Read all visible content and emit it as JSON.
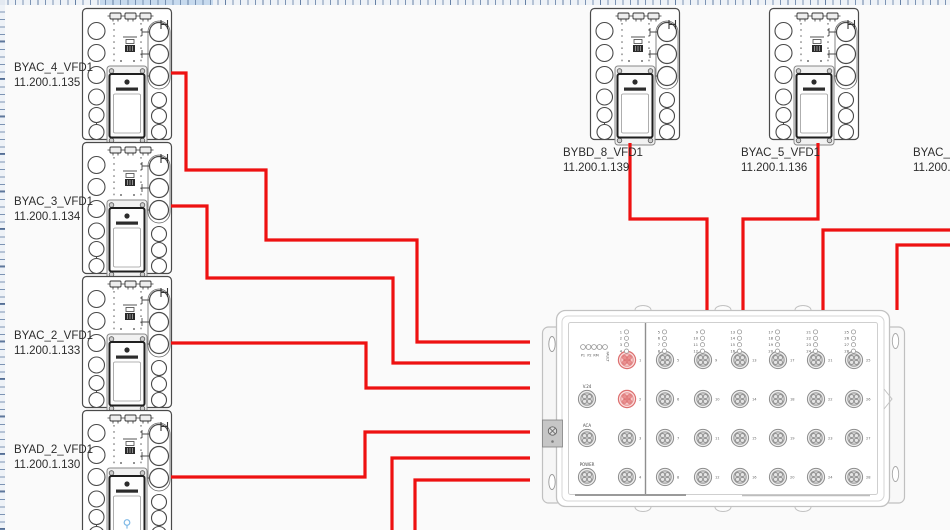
{
  "colors": {
    "connection_red": "#ee1111",
    "canvas_bg": "#fafafa",
    "highlight_port": "#e88787"
  },
  "devices": [
    {
      "id": "byac4",
      "name": "BYAC_4_VFD1",
      "ip": "11.200.1.135"
    },
    {
      "id": "byac3",
      "name": "BYAC_3_VFD1",
      "ip": "11.200.1.134"
    },
    {
      "id": "byac2",
      "name": "BYAC_2_VFD1",
      "ip": "11.200.1.133"
    },
    {
      "id": "byad2",
      "name": "BYAD_2_VFD1",
      "ip": "11.200.1.130"
    },
    {
      "id": "bybd8",
      "name": "BYBD_8_VFD1",
      "ip": "11.200.1.139"
    },
    {
      "id": "byac5",
      "name": "BYAC_5_VFD1",
      "ip": "11.200.1.136"
    },
    {
      "id": "byac6",
      "name": "BYAC_6_",
      "ip": "11.200.1"
    }
  ],
  "switch": {
    "status_leds": [
      "P1",
      "P2",
      "RM",
      "FAULT"
    ],
    "side_ports": [
      "V.24",
      "ACA",
      "POWER"
    ],
    "port_columns": [
      [
        1,
        2,
        3,
        4
      ],
      [
        5,
        6,
        7,
        8
      ],
      [
        9,
        10,
        11,
        12
      ],
      [
        13,
        14,
        15,
        16
      ],
      [
        17,
        18,
        19,
        20
      ],
      [
        21,
        22,
        23,
        24
      ],
      [
        25,
        26,
        27,
        28
      ]
    ],
    "highlighted_ports": [
      1,
      2
    ]
  },
  "connections": [
    {
      "from": "BYAC_4_VFD1",
      "to": "switch",
      "points": [
        [
          171,
          73
        ],
        [
          186,
          73
        ],
        [
          186,
          170
        ],
        [
          266,
          170
        ],
        [
          266,
          240
        ],
        [
          417,
          240
        ],
        [
          417,
          342
        ],
        [
          530,
          342
        ]
      ]
    },
    {
      "from": "BYAC_3_VFD1",
      "to": "switch",
      "points": [
        [
          171,
          206
        ],
        [
          207,
          206
        ],
        [
          207,
          278
        ],
        [
          393,
          278
        ],
        [
          393,
          363
        ],
        [
          530,
          363
        ]
      ]
    },
    {
      "from": "BYAC_2_VFD1",
      "to": "switch",
      "points": [
        [
          171,
          343
        ],
        [
          366,
          343
        ],
        [
          366,
          388
        ],
        [
          530,
          388
        ]
      ]
    },
    {
      "from": "BYAD_2_VFD1",
      "to": "switch",
      "points": [
        [
          171,
          477
        ],
        [
          365,
          477
        ],
        [
          365,
          432
        ],
        [
          530,
          432
        ]
      ]
    },
    {
      "from": "offscreen-bottom-1",
      "to": "switch",
      "points": [
        [
          392,
          531
        ],
        [
          392,
          458
        ],
        [
          530,
          458
        ]
      ]
    },
    {
      "from": "offscreen-bottom-2",
      "to": "switch",
      "points": [
        [
          415,
          531
        ],
        [
          415,
          480
        ],
        [
          530,
          480
        ]
      ]
    },
    {
      "from": "BYBD_8_VFD1",
      "to": "switch",
      "points": [
        [
          630,
          143
        ],
        [
          630,
          219
        ],
        [
          707,
          219
        ],
        [
          707,
          310
        ]
      ]
    },
    {
      "from": "BYAC_5_VFD1",
      "to": "switch",
      "points": [
        [
          818,
          143
        ],
        [
          818,
          219
        ],
        [
          743,
          219
        ],
        [
          743,
          310
        ]
      ]
    },
    {
      "from": "BYAC_6_",
      "to": "switch",
      "points": [
        [
          951,
          230
        ],
        [
          823,
          230
        ],
        [
          823,
          310
        ]
      ]
    },
    {
      "from": "BYAC_6_",
      "to": "switch",
      "points": [
        [
          951,
          245
        ],
        [
          897,
          245
        ],
        [
          897,
          310
        ]
      ]
    }
  ]
}
